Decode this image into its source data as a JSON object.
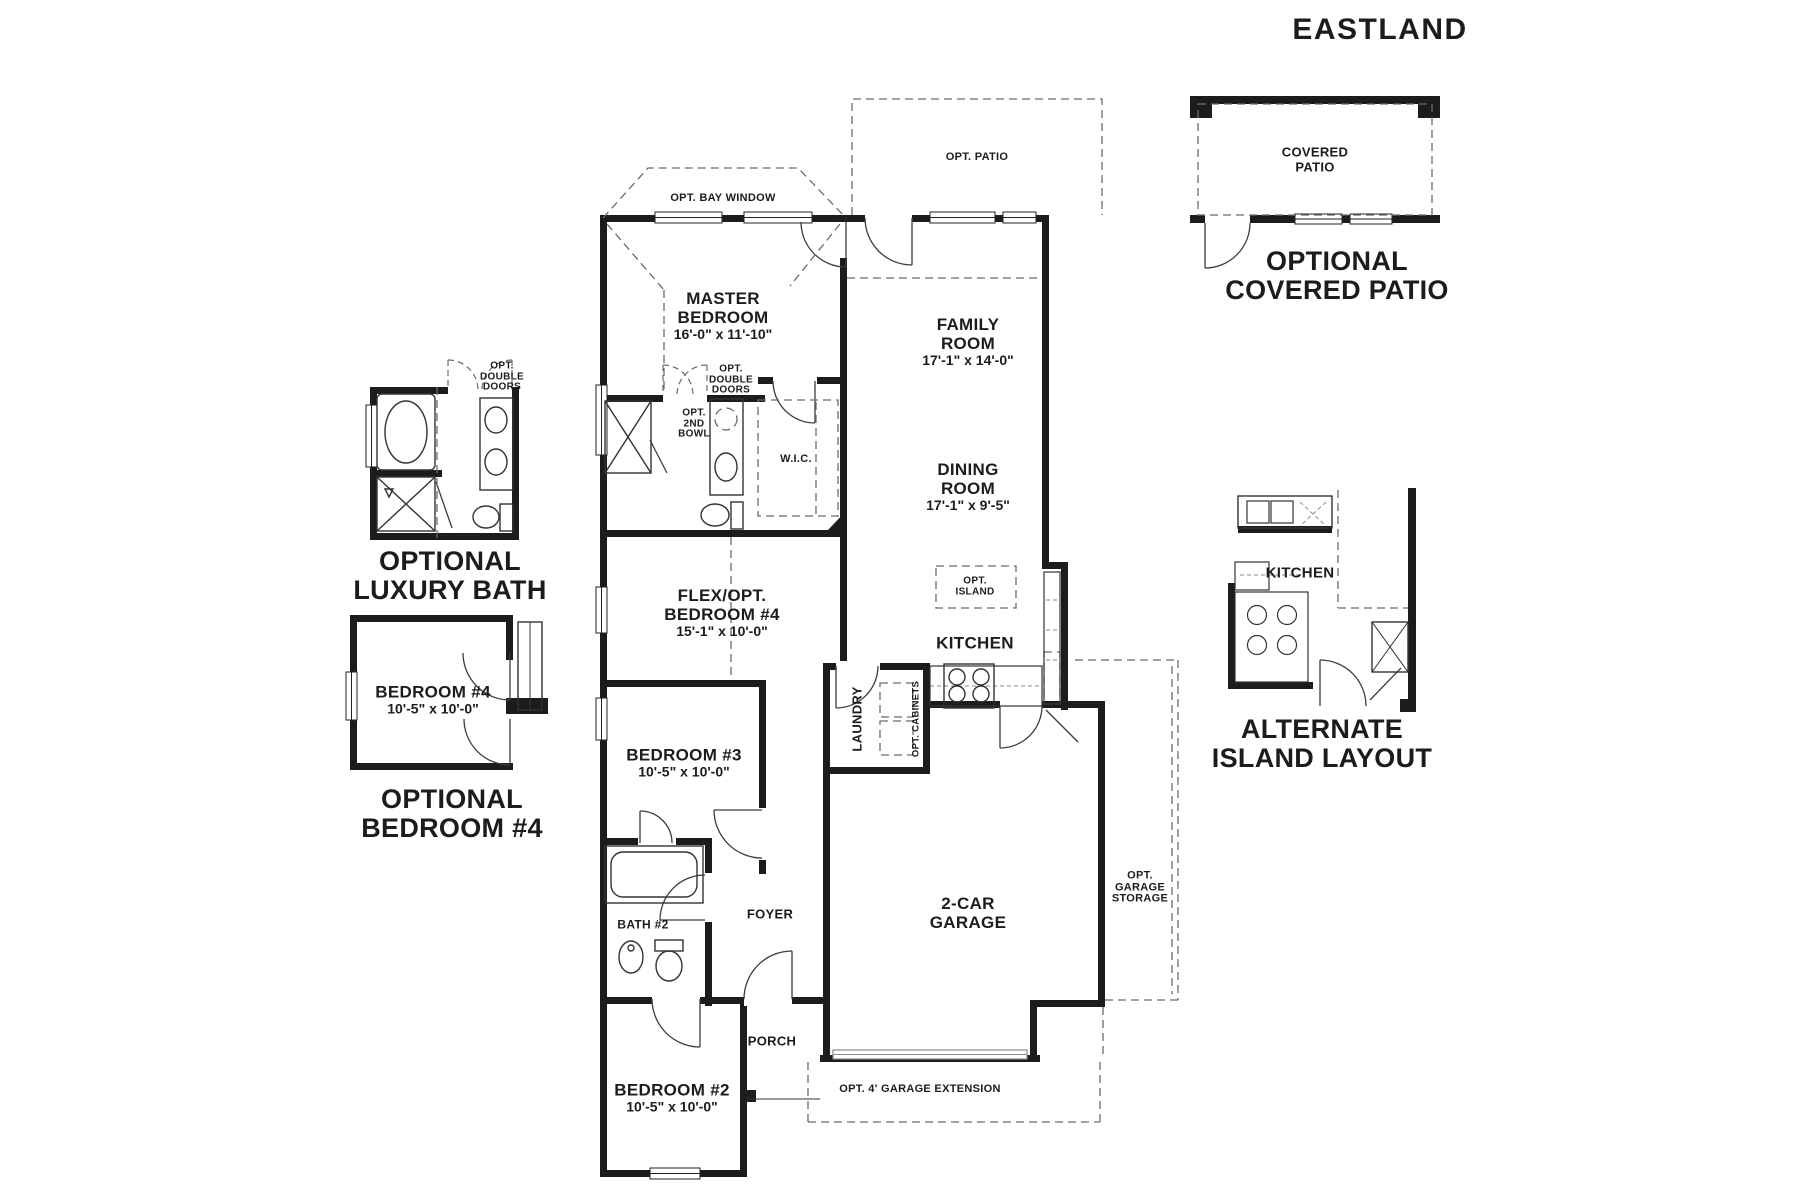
{
  "title": "EASTLAND",
  "colors": {
    "wall": "#1c1c1c",
    "line": "#3c3c3c",
    "dash": "#6b6b6b",
    "garage_door": "#8a8a8a",
    "background": "#ffffff"
  },
  "main": {
    "opt_patio": "OPT. PATIO",
    "opt_bay_window": "OPT. BAY WINDOW",
    "master_bedroom": {
      "line1": "MASTER",
      "line2": "BEDROOM",
      "dims": "16'-0\" x 11'-10\""
    },
    "family_room": {
      "line1": "FAMILY",
      "line2": "ROOM",
      "dims": "17'-1\" x 14'-0\""
    },
    "dining_room": {
      "line1": "DINING",
      "line2": "ROOM",
      "dims": "17'-1\" x 9'-5\""
    },
    "master_bath": {
      "opt_double_doors": {
        "line1": "OPT.",
        "line2": "DOUBLE",
        "line3": "DOORS"
      },
      "opt_2nd_bowl": {
        "line1": "OPT.",
        "line2": "2ND",
        "line3": "BOWL"
      },
      "wic": "W.I.C."
    },
    "flex_bedroom": {
      "line1": "FLEX/OPT.",
      "line2": "BEDROOM #4",
      "dims": "15'-1\" x 10'-0\""
    },
    "kitchen": {
      "label": "KITCHEN",
      "opt_island": {
        "line1": "OPT.",
        "line2": "ISLAND"
      }
    },
    "laundry": {
      "label": "LAUNDRY",
      "opt_cabinets": "OPT. CABINETS"
    },
    "bedroom3": {
      "name": "BEDROOM #3",
      "dims": "10'-5\" x 10'-0\""
    },
    "bath2": "BATH #2",
    "foyer": "FOYER",
    "garage": {
      "line1": "2-CAR",
      "line2": "GARAGE",
      "opt_storage": {
        "line1": "OPT.",
        "line2": "GARAGE",
        "line3": "STORAGE"
      },
      "opt_extension": "OPT. 4' GARAGE EXTENSION"
    },
    "porch": "PORCH",
    "bedroom2": {
      "name": "BEDROOM #2",
      "dims": "10'-5\" x 10'-0\""
    }
  },
  "insets": {
    "covered_patio": {
      "room_line1": "COVERED",
      "room_line2": "PATIO",
      "caption_line1": "OPTIONAL",
      "caption_line2": "COVERED PATIO"
    },
    "luxury_bath": {
      "opt_double_doors": {
        "line1": "OPT.",
        "line2": "DOUBLE",
        "line3": "DOORS"
      },
      "caption_line1": "OPTIONAL",
      "caption_line2": "LUXURY BATH"
    },
    "bedroom4": {
      "name": "BEDROOM #4",
      "dims": "10'-5\" x 10'-0\"",
      "caption_line1": "OPTIONAL",
      "caption_line2": "BEDROOM #4"
    },
    "alt_island": {
      "kitchen": "KITCHEN",
      "caption_line1": "ALTERNATE",
      "caption_line2": "ISLAND LAYOUT"
    }
  }
}
